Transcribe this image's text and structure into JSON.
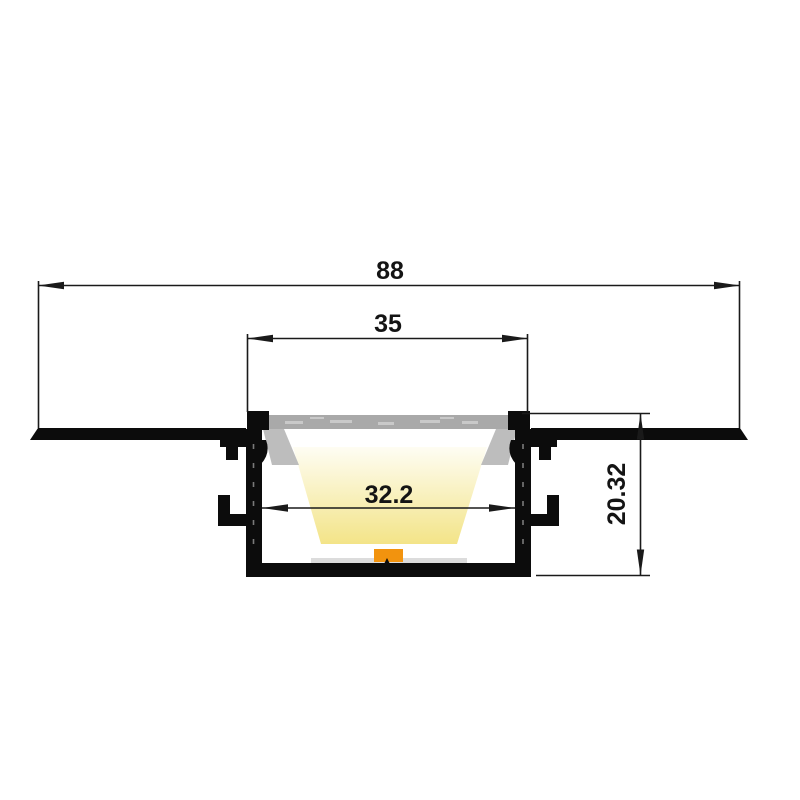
{
  "drawing": {
    "subject": "recessed-led-aluminium-profile-cross-section",
    "dimensions": {
      "overall_width": "88",
      "opening_width": "35",
      "inner_width": "32.2",
      "height": "20.32"
    },
    "colors": {
      "profile_black": "#0c0c0c",
      "line_black": "#1a1a1a",
      "diffuser_gray": "#a9a9a9",
      "diffuser_streak": "#c9c9c9",
      "wedge_gray": "#bdbdbd",
      "beam_light": "#fefdf3",
      "beam_yellow": "#f3e488",
      "led_orange": "#f2930e",
      "pcb_gray": "#dcdcdc",
      "background": "#ffffff"
    }
  }
}
